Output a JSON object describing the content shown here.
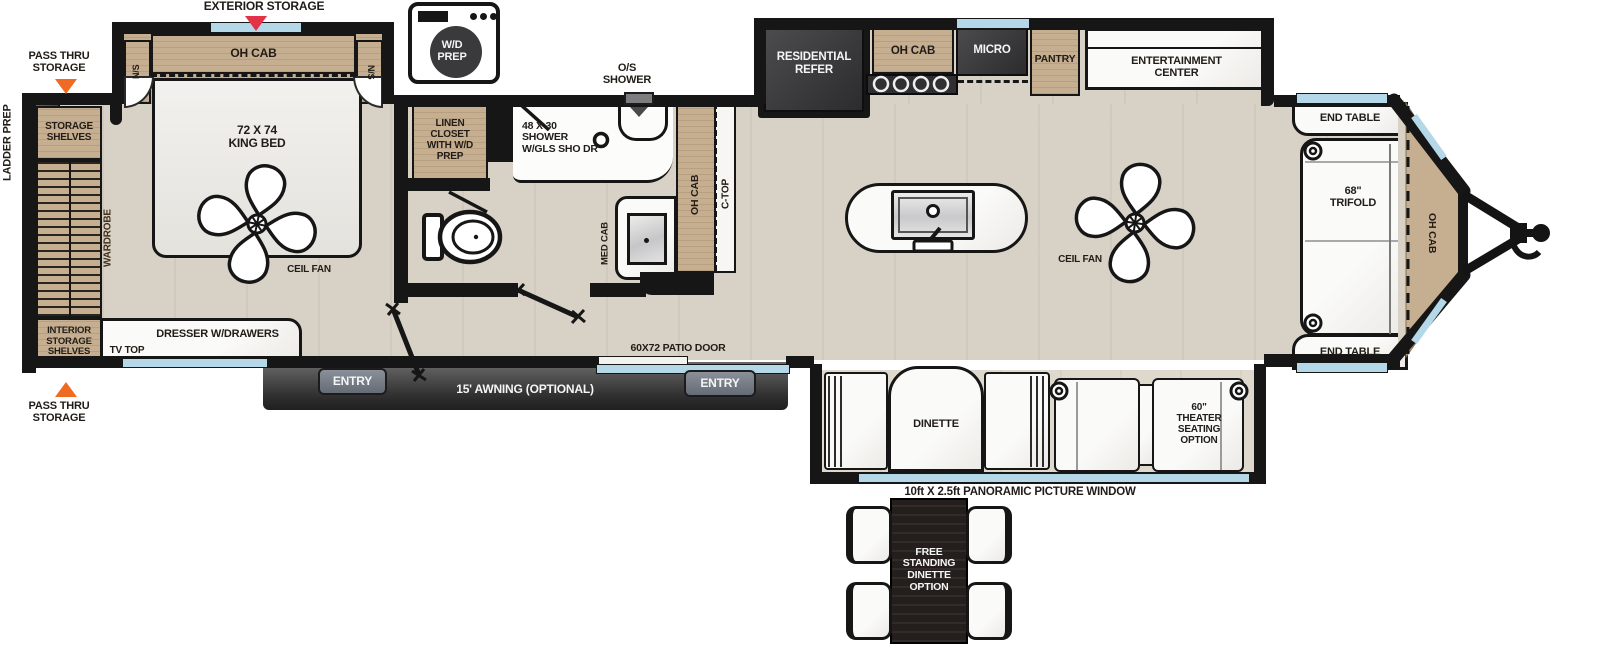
{
  "plan_title": "travel-trailer-floorplan",
  "colors": {
    "floor": "#d8d2c6",
    "wood_cabinet": "#c6ae90",
    "wall": "#161616",
    "appliance_dark": "#3d3d3e",
    "window_blue": "#b5d8e8",
    "marker_red": "#e33246",
    "marker_orange": "#ef6b22",
    "awning_gray": "#3a3a3a",
    "entry_tab_gray": "#7c828b",
    "counter_white": "#f7f6f3"
  },
  "labels": {
    "exterior_storage": "EXTERIOR STORAGE",
    "pass_thru": "PASS THRU\nSTORAGE",
    "ladder_prep": "LADDER PREP",
    "storage_shelves": "STORAGE\nSHELVES",
    "wardrobe": "WARDROBE",
    "interior_storage": "INTERIOR\nSTORAGE\nSHELVES",
    "ns": "N/S",
    "oh_cab": "OH CAB",
    "king_bed": "72 X 74\nKING BED",
    "ceil_fan": "CEIL FAN",
    "dresser": "DRESSER W/DRAWERS",
    "tv_top": "TV TOP",
    "wd_prep": "W/D\nPREP",
    "linen_closet": "LINEN\nCLOSET\nWITH W/D\nPREP",
    "shower": "48 X 30\nSHOWER\nW/GLS SHO DR",
    "os_shower": "O/S\nSHOWER",
    "med_cab": "MED CAB",
    "c_top": "C-TOP",
    "residential_refer": "RESIDENTIAL\nREFER",
    "micro": "MICRO",
    "pantry": "PANTRY",
    "entertainment_center": "ENTERTAINMENT\nCENTER",
    "end_table": "END TABLE",
    "trifold": "68\"\nTRIFOLD",
    "dinette": "DINETTE",
    "theater_seating": "60\"\nTHEATER\nSEATING\nOPTION",
    "panoramic_window": "10ft X 2.5ft PANORAMIC PICTURE WINDOW",
    "patio_door": "60X72 PATIO DOOR",
    "entry": "ENTRY",
    "awning": "15' AWNING (OPTIONAL)",
    "free_standing_dinette": "FREE\nSTANDING\nDINETTE\nOPTION"
  }
}
